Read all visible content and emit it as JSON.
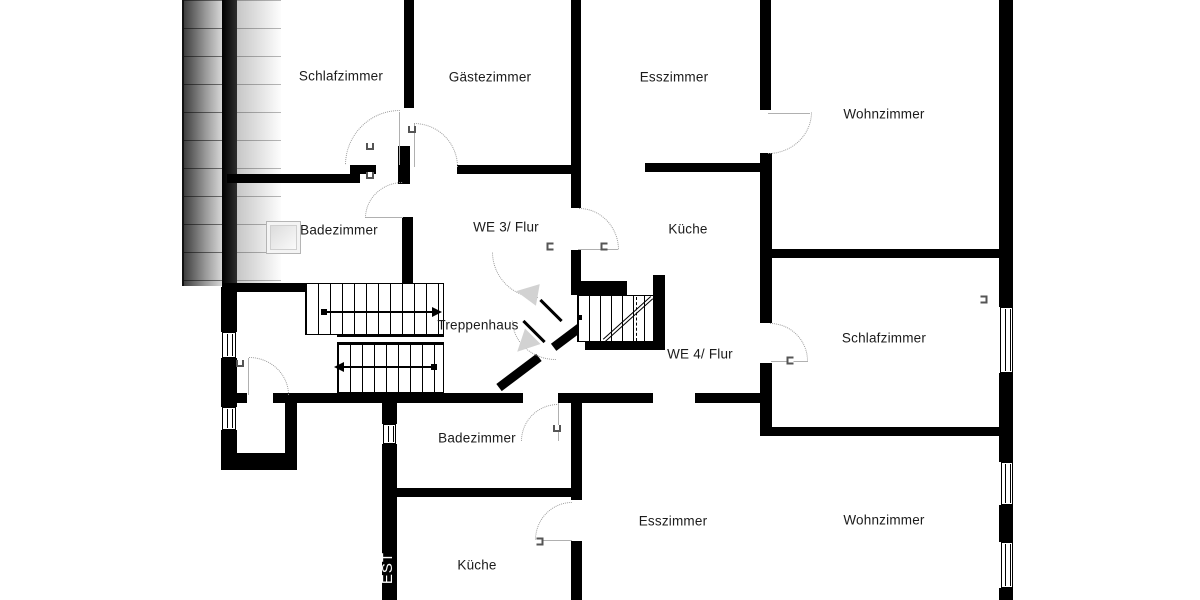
{
  "plan": {
    "type": "floorplan",
    "language": "de",
    "colors": {
      "wall": "#000000",
      "label": "#1b1b1b",
      "door_arc": "#9a9a9a",
      "direction_arrow_fill": "#d2d2d2",
      "wall_text": "#ffffff",
      "roof_hatch_dark": "#3f3f3f",
      "roof_hatch_light": "#fdfdfd"
    },
    "labels": {
      "schlafzimmer_top": "Schlafzimmer",
      "gaestezimmer": "Gästezimmer",
      "esszimmer_top": "Esszimmer",
      "wohnzimmer_top": "Wohnzimmer",
      "badezimmer_top": "Badezimmer",
      "we3_flur": "WE 3/ Flur",
      "kueche_top": "Küche",
      "treppenhaus": "Treppenhaus",
      "schlafzimmer_right": "Schlafzimmer",
      "we4_flur": "WE 4/ Flur",
      "badezimmer_bottom": "Badezimmer",
      "esszimmer_bottom": "Esszimmer",
      "wohnzimmer_bottom": "Wohnzimmer",
      "kueche_bottom": "Küche",
      "wall_text": "EST"
    },
    "units": {
      "we3": [
        "Schlafzimmer",
        "Gästezimmer",
        "Badezimmer",
        "Küche",
        "WE 3/ Flur"
      ],
      "we4": [
        "Schlafzimmer",
        "Esszimmer",
        "Wohnzimmer",
        "Badezimmer",
        "Küche",
        "WE 4/ Flur"
      ],
      "shared": [
        "Treppenhaus"
      ]
    }
  }
}
